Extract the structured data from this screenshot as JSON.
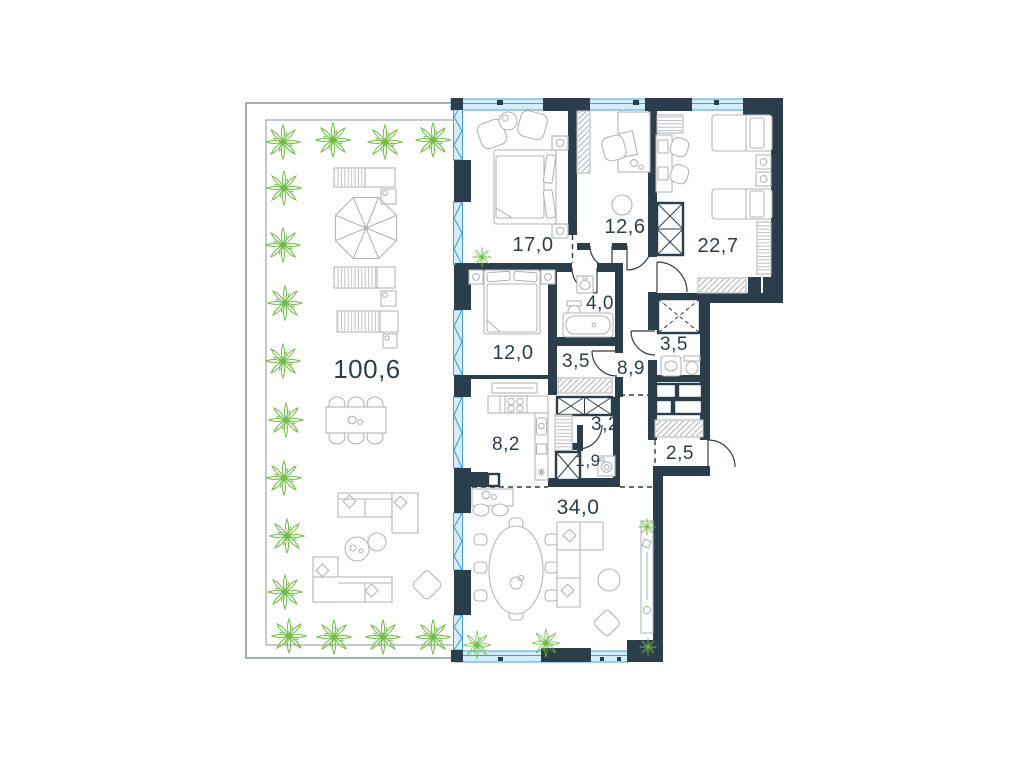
{
  "plan": {
    "title": "apartment-floor-plan",
    "rooms": [
      {
        "id": "terrace",
        "area": "100,6"
      },
      {
        "id": "bedroom-1",
        "area": "17,0"
      },
      {
        "id": "office",
        "area": "12,6"
      },
      {
        "id": "bedroom-2",
        "area": "22,7"
      },
      {
        "id": "bathroom",
        "area": "4,0"
      },
      {
        "id": "bedroom-3",
        "area": "12,0"
      },
      {
        "id": "wardrobe-hall",
        "area": "3,5"
      },
      {
        "id": "hallway",
        "area": "8,9"
      },
      {
        "id": "shower-room",
        "area": "3,5"
      },
      {
        "id": "kitchen",
        "area": "8,2"
      },
      {
        "id": "closet",
        "area": "3,2"
      },
      {
        "id": "laundry",
        "area": "1,9"
      },
      {
        "id": "entry",
        "area": "2,5"
      },
      {
        "id": "living-dining",
        "area": "34,0"
      }
    ],
    "colors": {
      "wall": "#2b3e4b",
      "window_line": "#3f9fd9",
      "window_fill": "#d6ecf9",
      "plant": "#6fbc43",
      "furniture": "#b3b6b8",
      "label": "#2b3e4b",
      "background": "#ffffff"
    }
  }
}
